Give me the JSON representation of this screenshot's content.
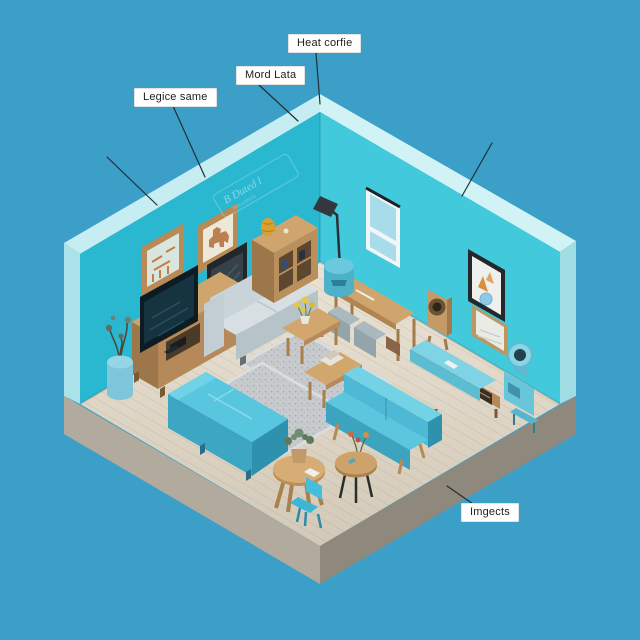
{
  "scene": {
    "description": "Isometric 3D render of a teal living room corner on a wooden floor platform, annotated with four callout labels",
    "background_color": "#3c9fc8"
  },
  "palette": {
    "left_wall": "#2ab7d0",
    "right_wall": "#42c9dc",
    "wall_edge_highlight": "#cdeff2",
    "floor_wood": "#ddd3c3",
    "platform_side_left": "#b2ab9d",
    "platform_side_right": "#8f897d",
    "furniture_blue": "#4fbcd9",
    "wood": "#c49a66",
    "gray_sofa": "#c9d4d9",
    "leader_line": "#1f3036",
    "label_background": "#ffffff",
    "label_text": "#1d1d1d"
  },
  "labels": {
    "legice": {
      "text": "Legice same"
    },
    "mord": {
      "text": "Mord Lata"
    },
    "heat": {
      "text": "Heat corfie"
    },
    "imgects": {
      "text": "Imgects"
    }
  },
  "wall_script": {
    "text": "B Duted l",
    "subtext": "btecsdttece"
  },
  "furniture": [
    "framed-chart-art",
    "framed-moose-art",
    "framed-botanical-art",
    "wall-script",
    "tv",
    "tv-stand",
    "potted-plant",
    "gray-sofa",
    "bookshelf",
    "gold-vase",
    "floor-lamp",
    "window",
    "blue-stool",
    "desk-with-storage-bins",
    "wooden-speaker-stand",
    "framed-abstract-art",
    "framed-landscape-art",
    "blue-sideboard",
    "blue-fan-unit",
    "area-rug-small",
    "area-rug-large",
    "coffee-table-with-flowers",
    "coffee-table-with-books",
    "blue-sectional-sofa",
    "blue-loveseat",
    "round-table-with-flowers",
    "round-wooden-table-with-plant",
    "blue-chair"
  ]
}
